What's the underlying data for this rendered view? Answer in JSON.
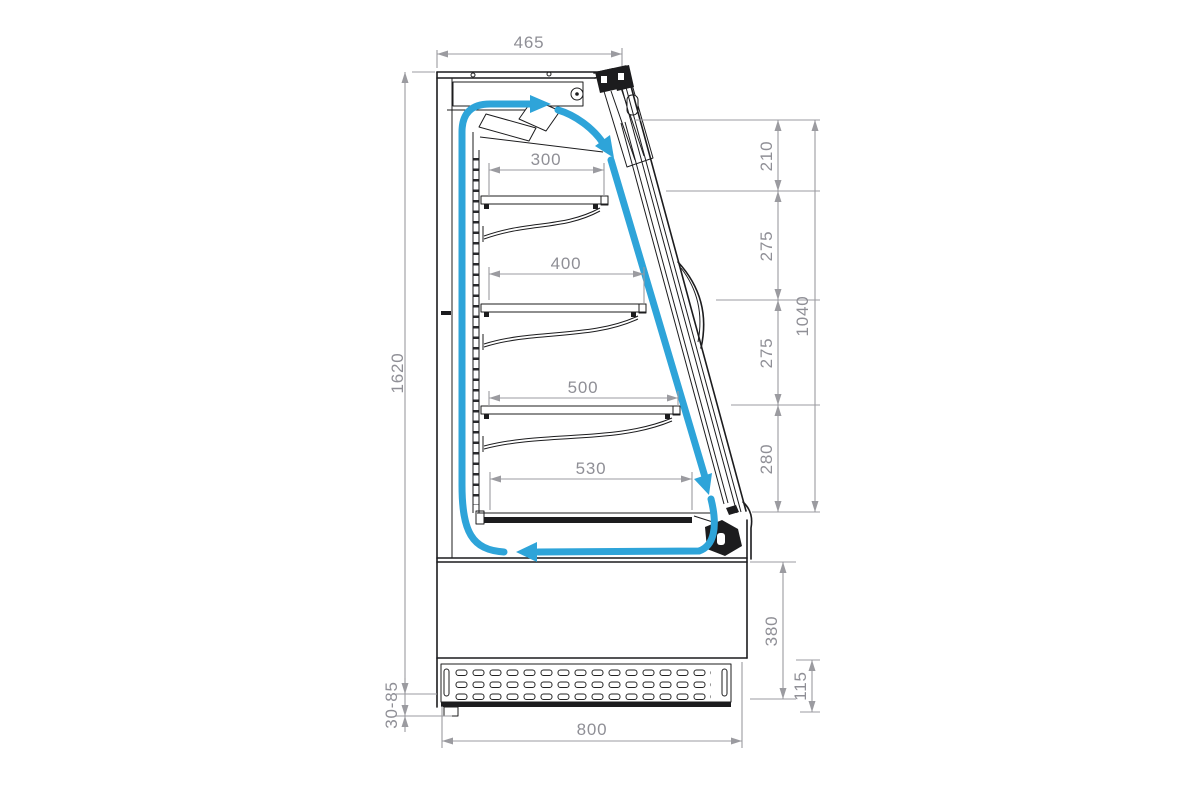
{
  "drawing": {
    "dims": {
      "top_depth": "465",
      "total_height": "1620",
      "shelf_300": "300",
      "shelf_400": "400",
      "shelf_500": "500",
      "deck_530": "530",
      "gap_210": "210",
      "gap_275_upper": "275",
      "gap_275_lower": "275",
      "gap_280": "280",
      "front_opening_height": "1040",
      "base_height": "380",
      "plinth_height": "115",
      "feet_adjust_range": "30-85",
      "base_depth": "800"
    },
    "colors": {
      "airflow": "#2EA4D9",
      "dim_line": "#9B9BA0",
      "dim_text": "#8F8F96",
      "outline": "#1C1C1E",
      "background": "#FFFFFF"
    }
  }
}
